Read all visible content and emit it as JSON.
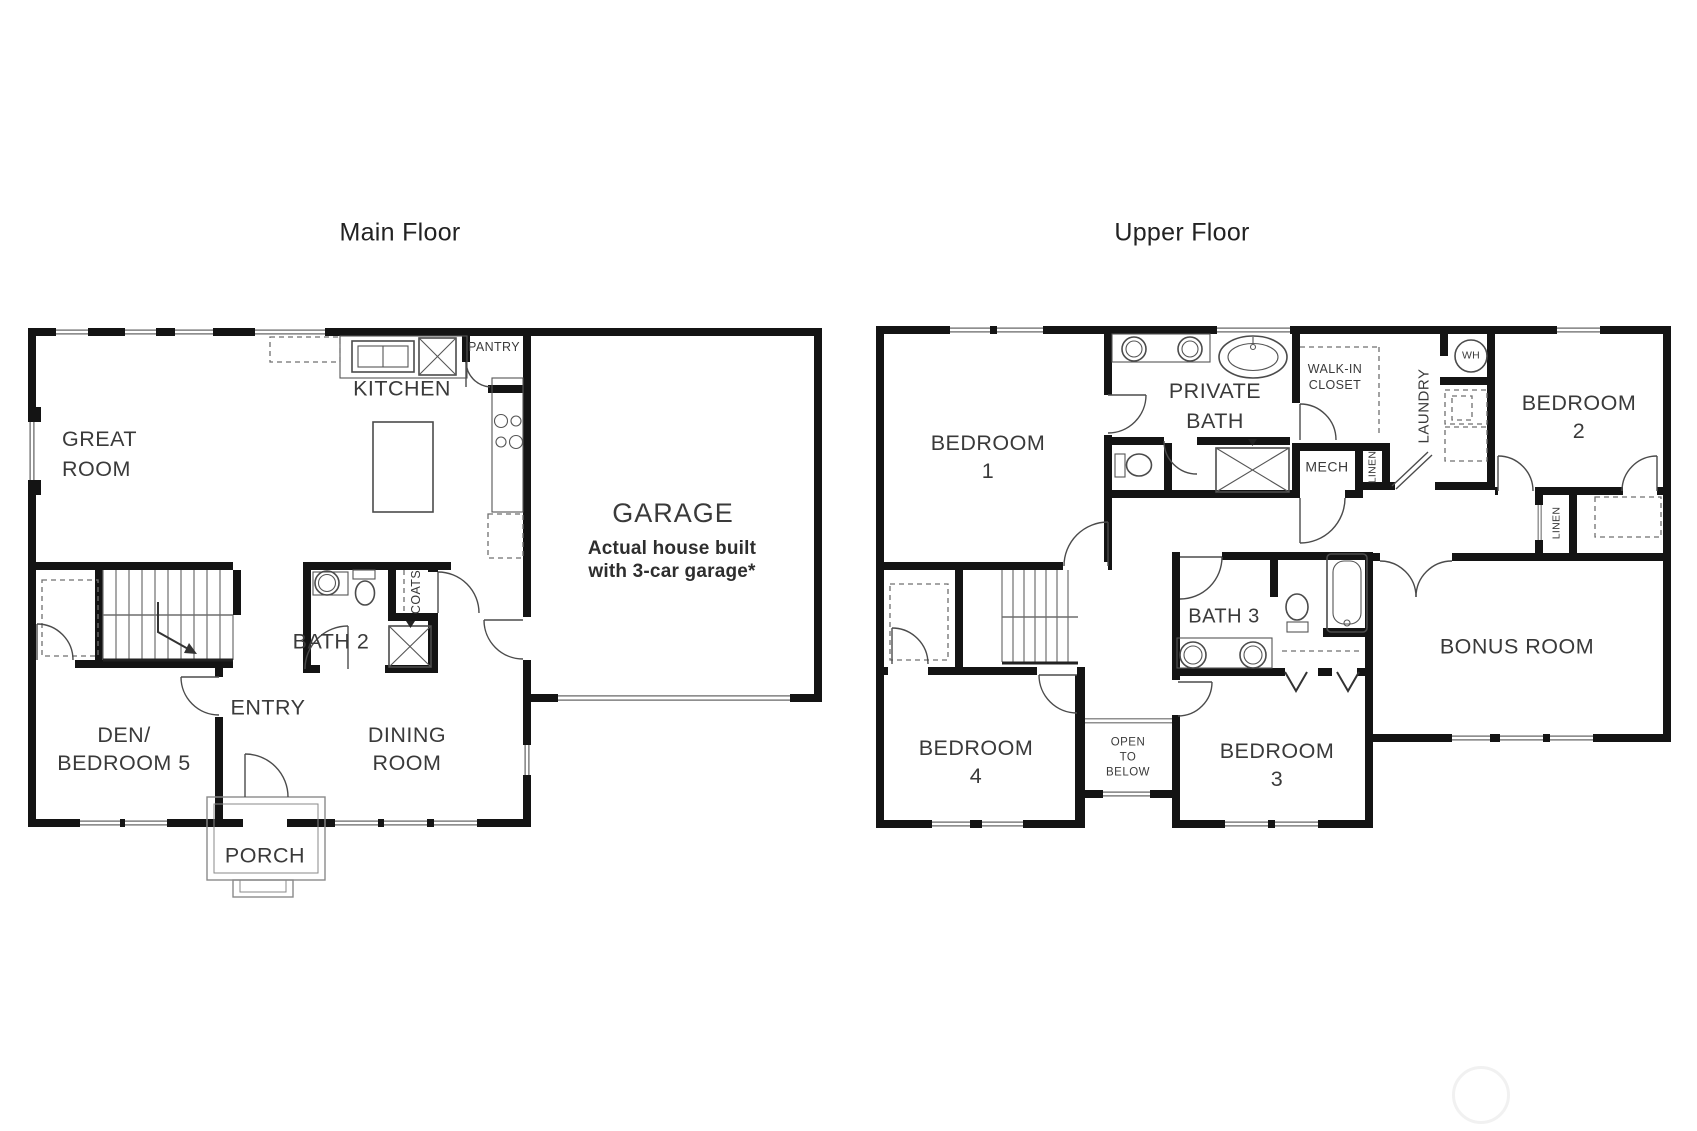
{
  "page": {
    "background": "#ffffff",
    "wall_color": "#141414",
    "fixture_line_color": "#4b4b4b",
    "window_line_color": "#8f8f8f",
    "text_color": "#3a3a3a"
  },
  "floors": {
    "main": {
      "title": "Main Floor",
      "labels": {
        "great_room": "GREAT\nROOM",
        "kitchen": "KITCHEN",
        "pantry": "PANTRY",
        "garage": "GARAGE",
        "garage_note": "Actual house built\nwith 3-car garage*",
        "bath2": "BATH 2",
        "coats": "COATS",
        "entry": "ENTRY",
        "den": "DEN/\nBEDROOM 5",
        "dining": "DINING\nROOM",
        "porch": "PORCH"
      }
    },
    "upper": {
      "title": "Upper Floor",
      "labels": {
        "bedroom1": "BEDROOM\n1",
        "private_bath": "PRIVATE\nBATH",
        "walk_in_closet": "WALK-IN\nCLOSET",
        "laundry": "LAUNDRY",
        "water_heater": "WH",
        "mech": "MECH",
        "linen_a": "LINEN",
        "bedroom2": "BEDROOM\n2",
        "linen_b": "LINEN",
        "bath3": "BATH 3",
        "bonus_room": "BONUS ROOM",
        "bedroom4": "BEDROOM\n4",
        "open_to_below": "OPEN\nTO\nBELOW",
        "bedroom3": "BEDROOM\n3"
      }
    }
  }
}
